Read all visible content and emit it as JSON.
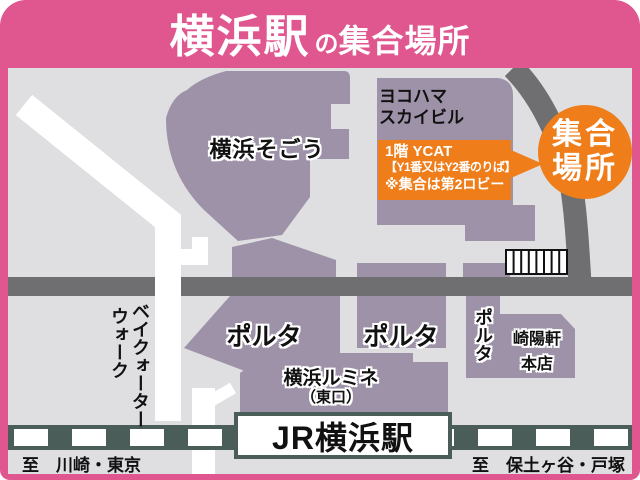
{
  "title": {
    "station": "横浜駅",
    "particle": "の",
    "suffix": "集合場所"
  },
  "buildings": {
    "sogo": "横浜そごう",
    "sky_building": [
      "ヨコハマ",
      "スカイビル"
    ],
    "porta_labels": [
      "ポルタ",
      "ポルタ",
      "ポルタ"
    ],
    "kiyoken": [
      "崎陽軒",
      "本店"
    ],
    "lumine": [
      "横浜ルミネ",
      "（東口）"
    ],
    "jr_station": "JR横浜駅"
  },
  "meeting_point": {
    "badge": [
      "集合",
      "場所"
    ],
    "callout": [
      "1階 YCAT",
      "【Y1番又はY2番のりば】",
      "※集合は第2ロビー"
    ]
  },
  "streets": {
    "bayquarter_walk": [
      "ベイクォーター",
      "ウォーク"
    ],
    "to_left": "至　川崎・東京",
    "to_right": "至　保土ヶ谷・戸塚"
  },
  "colors": {
    "frame_pink": "#E0568F",
    "building_purple": "#9E92A9",
    "road_gray": "#6F6F71",
    "railway_green": "#4B5D58",
    "accent_orange": "#EE7D1A",
    "map_bg": "#DFDEE1"
  }
}
